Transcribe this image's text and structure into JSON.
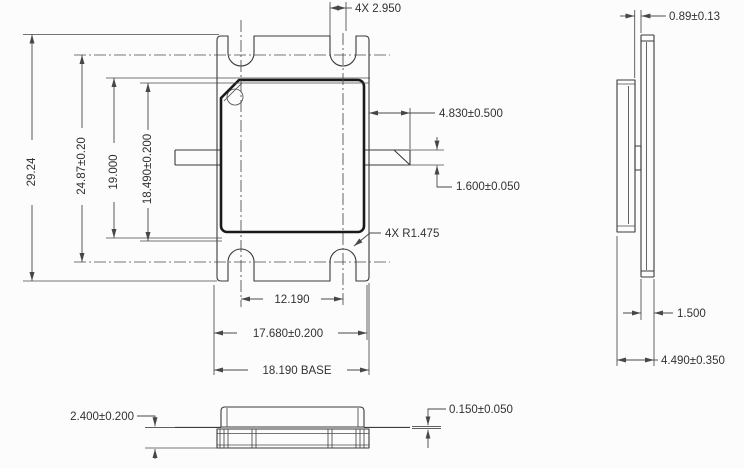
{
  "drawing": {
    "type": "mechanical-package-outline",
    "colors": {
      "ink": "#3a3a3a",
      "cap_ink": "#191919",
      "background": "#fcfcfc"
    }
  },
  "dims": {
    "front": {
      "notch_width": "4X 2.950",
      "overall_height": "29.24",
      "notch_centers_height": "24.87±0.20",
      "body_height": "19.000",
      "seat_height": "18.490±0.200",
      "lead_length": "4.830±0.500",
      "lead_width": "1.600±0.050",
      "corner_radius": "4X R1.475",
      "notch_spacing": "12.190",
      "body_width": "17.680±0.200",
      "base_width": "18.190 BASE"
    },
    "side": {
      "flange_to_cap": "0.89±0.13",
      "cap_thickness": "1.500",
      "overall_depth": "4.490±0.350"
    },
    "front_elevation": {
      "flange_thickness": "2.400±0.200",
      "lead_thickness": "0.150±0.050"
    }
  }
}
